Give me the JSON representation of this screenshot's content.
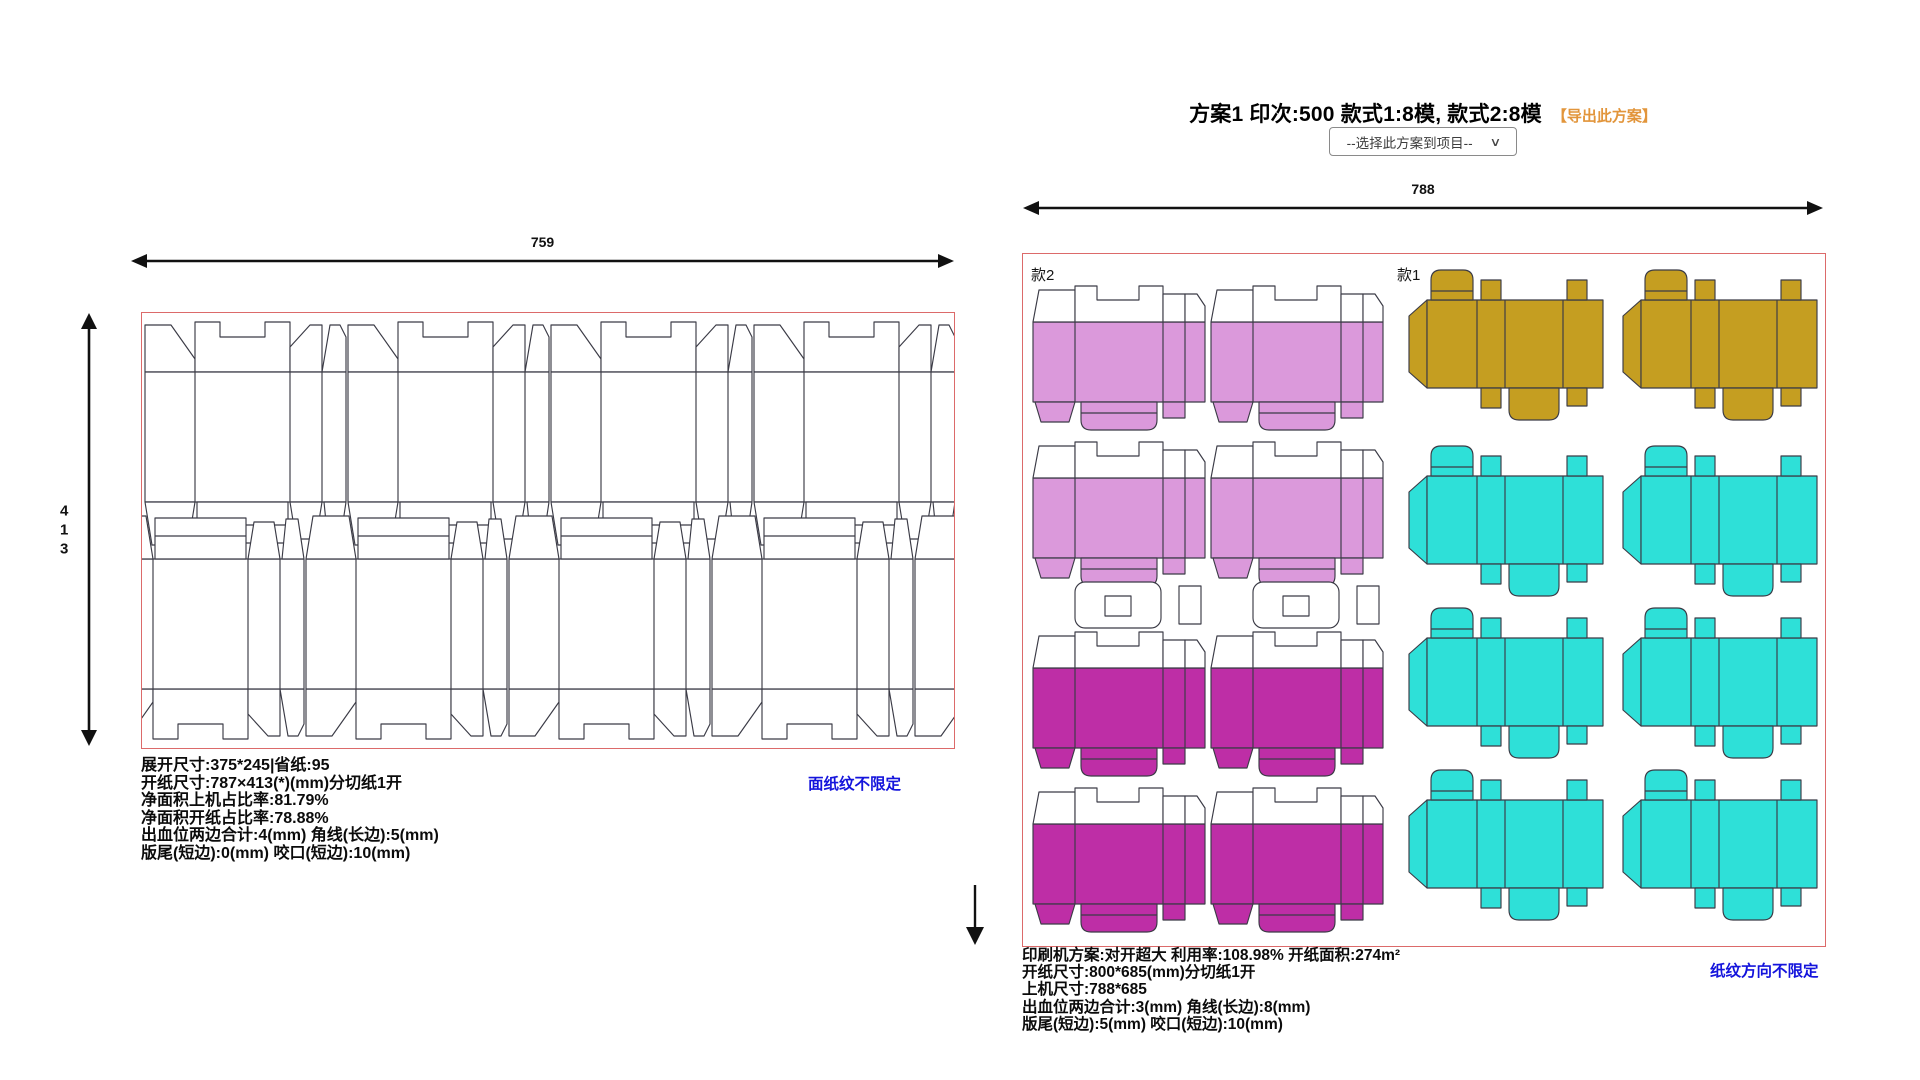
{
  "scheme": {
    "title": "方案1 印次:500 款式1:8模, 款式2:8模",
    "export_link": "【导出此方案】",
    "select_placeholder": "--选择此方案到项目--"
  },
  "icons": {
    "select_chevron": "∨"
  },
  "left_panel": {
    "width_label": "759",
    "height_label": "413",
    "height_digits": [
      "4",
      "1",
      "3"
    ],
    "grain_link": "面纸纹不限定",
    "info_lines": [
      "展开尺寸:375*245|省纸:95",
      "开纸尺寸:787×413(*)(mm)分切纸1开",
      "净面积上机占比率:81.79%",
      "净面积开纸占比率:78.88%",
      "出血位两边合计:4(mm) 角线(长边):5(mm)",
      "版尾(短边):0(mm) 咬口(短边):10(mm)"
    ]
  },
  "right_panel": {
    "width_label": "788",
    "style1_label": "款1",
    "style2_label": "款2",
    "grain_link": "纸纹方向不限定",
    "info_lines": [
      "印刷机方案:对开超大 利用率:108.98% 开纸面积:274m²",
      "开纸尺寸:800*685(mm)分切纸1开",
      "上机尺寸:788*685",
      "出血位两边合计:3(mm) 角线(长边):8(mm)",
      "版尾(短边):5(mm) 咬口(短边):10(mm)"
    ]
  },
  "colors": {
    "border_red": "#DC6A6A",
    "plum": "#DB99DB",
    "magenta": "#BE2EA6",
    "gold": "#C59E21",
    "cyan": "#2EE0D8",
    "link_blue": "#1414DC",
    "accent_orange": "#E2953B"
  }
}
